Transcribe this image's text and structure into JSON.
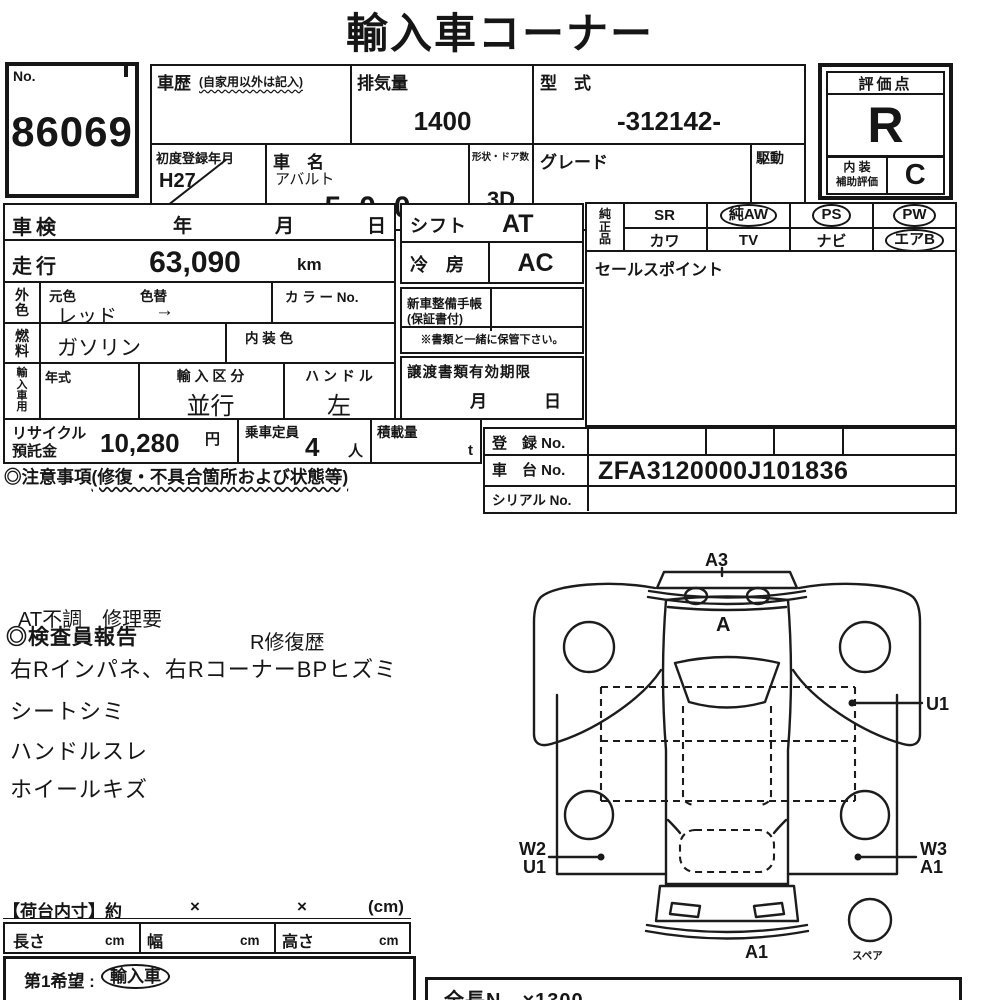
{
  "title": "輸入車コーナー",
  "no_box": {
    "label": "No.",
    "value": "86069"
  },
  "vehicle": {
    "history_label": "車歴",
    "history_note": "(自家用以外は記入)",
    "displacement_label": "排気量",
    "displacement_value": "1400",
    "model_code_label": "型　式",
    "model_code_value": "-312142-",
    "first_reg_label": "初度登録年月",
    "first_reg_value": "H27",
    "first_reg_suffix": "月",
    "name_label": "車　名",
    "maker": "アバルト",
    "model": "500",
    "shape_label": "形状・ドア数",
    "shape_value": "3D",
    "grade_label": "グレード",
    "grade_value": "",
    "drive_label": "駆動",
    "drive_value": "2WD"
  },
  "rating": {
    "header": "評価点",
    "score": "R",
    "interior_line1": "内 装",
    "interior_line2": "補助評価",
    "interior_score": "C"
  },
  "left_table": {
    "shaken_label": "車検",
    "year": "年",
    "month": "月",
    "day": "日",
    "mileage_label": "走行",
    "mileage_value": "63,090",
    "mileage_unit": "km",
    "ext_color_label": "外色",
    "orig_color_label": "元色",
    "color_change_label": "色替",
    "ext_color_value": "レッド",
    "arrow": "→",
    "color_no_label": "カ ラ ー No.",
    "fuel_label": "燃料",
    "fuel_value": "ガソリン",
    "interior_color_label": "内 装 色",
    "import_label": "輸入車用",
    "year_model_label": "年式",
    "import_class_label": "輸 入 区 分",
    "import_class_value": "並行",
    "handle_label": "ハ ン ド ル",
    "handle_value": "左"
  },
  "recycle": {
    "label1": "リサイクル",
    "label2": "預託金",
    "value": "10,280",
    "unit": "円",
    "capacity_label": "乗車定員",
    "capacity_value": "4",
    "capacity_unit": "人",
    "load_label": "積載量",
    "load_unit": "t"
  },
  "caution": {
    "prefix": "◎注意事項",
    "note": "(修復・不具合箇所および状態等)"
  },
  "mid": {
    "shift_label": "シフト",
    "shift_value": "AT",
    "ac_label": "冷　房",
    "ac_value": "AC",
    "book_label1": "新車整備手帳",
    "book_label2": "(保証書付)",
    "book_note": "※書類と一緒に保管下さい。",
    "transfer_label": "譲渡書類有効期限",
    "transfer_month": "月",
    "transfer_day": "日"
  },
  "genuine": {
    "label": "純正品",
    "rows": [
      [
        {
          "t": "SR"
        },
        {
          "t": "純AW"
        },
        {
          "t": "PS"
        },
        {
          "t": "PW"
        }
      ],
      [
        {
          "t": "カワ"
        },
        {
          "t": "TV"
        },
        {
          "t": "ナビ"
        },
        {
          "t": "エアB"
        }
      ]
    ]
  },
  "sales": {
    "label": "セールスポイント"
  },
  "registration": {
    "reg_label": "登　録 No.",
    "chassis_label": "車　台 No.",
    "chassis_value": "ZFA3120000J101836",
    "serial_label": "シリアル No."
  },
  "report": {
    "line0": "AT不調　修理要",
    "heading": "◎検査員報告",
    "repair": "R修復歴",
    "lines": [
      "右Rインパネ、右RコーナーBPヒズミ",
      "シートシミ",
      "ハンドルスレ",
      "ホイールキズ"
    ]
  },
  "diagram": {
    "front_top": "A3",
    "hood": "A",
    "right_side": "U1",
    "left_rear1": "W2",
    "left_rear2": "U1",
    "right_rear1": "W3",
    "right_rear2": "A1",
    "rear": "A1",
    "spare": "スペア"
  },
  "cargo": {
    "heading": "【荷台内寸】約",
    "x1": "×",
    "x2": "×",
    "unit": "(cm)",
    "len_label": "長さ",
    "len_unit": "cm",
    "wid_label": "幅",
    "wid_unit": "cm",
    "hgt_label": "高さ",
    "hgt_unit": "cm"
  },
  "choice": {
    "prefix": "第1希望 :",
    "value": "輸入車"
  },
  "footer": {
    "partial": "全長N　×1300"
  }
}
